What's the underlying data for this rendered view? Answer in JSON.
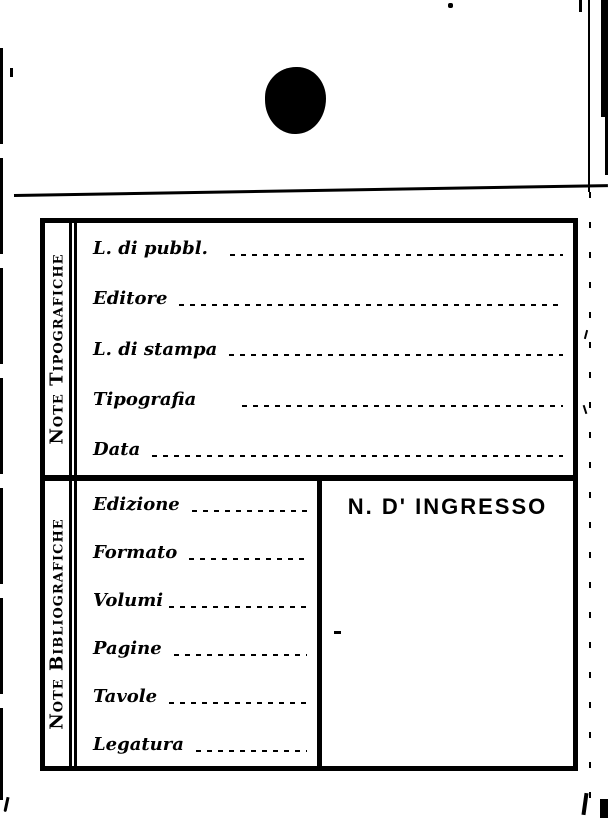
{
  "colors": {
    "ink": "#000000",
    "paper": "#ffffff"
  },
  "card": {
    "sections": [
      {
        "title": "Note Tipografiche",
        "fields": [
          {
            "label": "L. di pubbl.",
            "value": ""
          },
          {
            "label": "Editore",
            "value": ""
          },
          {
            "label": "L. di stampa",
            "value": ""
          },
          {
            "label": "Tipografia",
            "value": ""
          },
          {
            "label": "Data",
            "value": ""
          }
        ]
      },
      {
        "title": "Note Bibliografiche",
        "fields": [
          {
            "label": "Edizione",
            "value": ""
          },
          {
            "label": "Formato",
            "value": ""
          },
          {
            "label": "Volumi",
            "value": ""
          },
          {
            "label": "Pagine",
            "value": ""
          },
          {
            "label": "Tavole",
            "value": ""
          },
          {
            "label": "Legatura",
            "value": ""
          }
        ],
        "ingresso_heading": "N. D' INGRESSO"
      }
    ]
  }
}
